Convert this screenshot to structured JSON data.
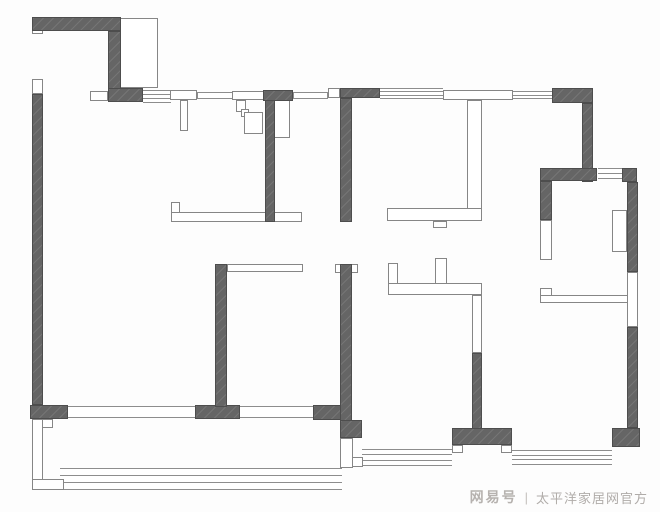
{
  "canvas": {
    "w": 660,
    "h": 512,
    "bg": "#fdfdfd"
  },
  "colors": {
    "wall_fill": "#656565",
    "wall_edge": "#4d4d4d",
    "partition_line": "#868686",
    "window_line": "#8d8d8d",
    "watermark_brand": "#b6b2af",
    "watermark_text": "#b0aca9"
  },
  "watermark": {
    "brand": "网易号",
    "divider": "|",
    "source": "太平洋家居网官方"
  },
  "floorplan": {
    "dark_walls": [
      {
        "name": "wall-entry-top",
        "x": 32,
        "y": 17,
        "w": 89,
        "h": 14
      },
      {
        "name": "wall-entry-right",
        "x": 108,
        "y": 31,
        "w": 13,
        "h": 58
      },
      {
        "name": "wall-entry-corner",
        "x": 108,
        "y": 88,
        "w": 35,
        "h": 14
      },
      {
        "name": "wall-west-exterior",
        "x": 32,
        "y": 94,
        "w": 11,
        "h": 311
      },
      {
        "name": "wall-sw-corner-block",
        "x": 30,
        "y": 405,
        "w": 38,
        "h": 14
      },
      {
        "name": "wall-south-a",
        "x": 195,
        "y": 405,
        "w": 45,
        "h": 14
      },
      {
        "name": "wall-south-b",
        "x": 313,
        "y": 405,
        "w": 39,
        "h": 15
      },
      {
        "name": "wall-bedroom1-left",
        "x": 215,
        "y": 264,
        "w": 12,
        "h": 143
      },
      {
        "name": "wall-bedroom1-right",
        "x": 340,
        "y": 264,
        "w": 12,
        "h": 158
      },
      {
        "name": "wall-bay-corner",
        "x": 340,
        "y": 420,
        "w": 22,
        "h": 18
      },
      {
        "name": "wall-kitchen",
        "x": 265,
        "y": 98,
        "w": 10,
        "h": 124
      },
      {
        "name": "wall-kitchen-header",
        "x": 263,
        "y": 90,
        "w": 30,
        "h": 11
      },
      {
        "name": "wall-mid-upper",
        "x": 340,
        "y": 98,
        "w": 12,
        "h": 124
      },
      {
        "name": "wall-mid-header",
        "x": 340,
        "y": 88,
        "w": 40,
        "h": 10
      },
      {
        "name": "wall-ne-corner",
        "x": 552,
        "y": 88,
        "w": 41,
        "h": 15
      },
      {
        "name": "wall-ne-connector",
        "x": 582,
        "y": 103,
        "w": 11,
        "h": 79
      },
      {
        "name": "wall-rightroom-top",
        "x": 540,
        "y": 168,
        "w": 57,
        "h": 13
      },
      {
        "name": "wall-rightroom-ne",
        "x": 622,
        "y": 168,
        "w": 15,
        "h": 14
      },
      {
        "name": "wall-east-upper",
        "x": 627,
        "y": 182,
        "w": 11,
        "h": 90
      },
      {
        "name": "wall-east-lower",
        "x": 627,
        "y": 327,
        "w": 11,
        "h": 101
      },
      {
        "name": "wall-se-corner-block",
        "x": 612,
        "y": 428,
        "w": 28,
        "h": 19
      },
      {
        "name": "wall-rightroom-left",
        "x": 540,
        "y": 181,
        "w": 12,
        "h": 39
      },
      {
        "name": "wall-bath-south",
        "x": 472,
        "y": 353,
        "w": 10,
        "h": 77
      },
      {
        "name": "wall-south-t-block",
        "x": 452,
        "y": 428,
        "w": 60,
        "h": 17
      }
    ],
    "outline_boxes": [
      {
        "name": "frame-entry-wall-tab",
        "x": 32,
        "y": 26,
        "w": 11,
        "h": 8
      },
      {
        "name": "frame-west-door",
        "x": 32,
        "y": 79,
        "w": 11,
        "h": 15
      },
      {
        "name": "frame-entry-door",
        "x": 90,
        "y": 91,
        "w": 18,
        "h": 10
      },
      {
        "name": "closet-entry",
        "x": 118,
        "y": 18,
        "w": 40,
        "h": 70
      },
      {
        "name": "partition-entry-cap",
        "x": 170,
        "y": 90,
        "w": 27,
        "h": 10
      },
      {
        "name": "partition-entry-leg",
        "x": 180,
        "y": 100,
        "w": 8,
        "h": 31
      },
      {
        "name": "frame-kitchen-door",
        "x": 232,
        "y": 91,
        "w": 36,
        "h": 9
      },
      {
        "name": "duct-step-1",
        "x": 236,
        "y": 100,
        "w": 10,
        "h": 12
      },
      {
        "name": "duct-step-2",
        "x": 241,
        "y": 109,
        "w": 8,
        "h": 8
      },
      {
        "name": "duct-step-3",
        "x": 244,
        "y": 112,
        "w": 19,
        "h": 22
      },
      {
        "name": "cabinet-kitchen",
        "x": 274,
        "y": 100,
        "w": 16,
        "h": 38
      },
      {
        "name": "frame-mid-door",
        "x": 328,
        "y": 88,
        "w": 12,
        "h": 10
      },
      {
        "name": "cap-bedroom1-right-a",
        "x": 335,
        "y": 264,
        "w": 7,
        "h": 9
      },
      {
        "name": "cap-bedroom1-right-b",
        "x": 351,
        "y": 264,
        "w": 7,
        "h": 9
      },
      {
        "name": "lintel-bedroom1",
        "x": 227,
        "y": 264,
        "w": 76,
        "h": 8
      },
      {
        "name": "shelf-living-tab",
        "x": 171,
        "y": 202,
        "w": 9,
        "h": 20
      },
      {
        "name": "shelf-living-bar",
        "x": 171,
        "y": 212,
        "w": 131,
        "h": 10
      },
      {
        "name": "frame-midroom-door-head",
        "x": 443,
        "y": 90,
        "w": 70,
        "h": 10
      },
      {
        "name": "partition-midroom",
        "x": 467,
        "y": 100,
        "w": 15,
        "h": 121
      },
      {
        "name": "bar-midroom-bottom",
        "x": 387,
        "y": 208,
        "w": 95,
        "h": 13
      },
      {
        "name": "notch-midroom",
        "x": 433,
        "y": 221,
        "w": 14,
        "h": 7
      },
      {
        "name": "bath-hook",
        "x": 388,
        "y": 263,
        "w": 10,
        "h": 21
      },
      {
        "name": "bath-wall-horizontal",
        "x": 388,
        "y": 283,
        "w": 94,
        "h": 12
      },
      {
        "name": "bath-tab",
        "x": 435,
        "y": 258,
        "w": 12,
        "h": 26
      },
      {
        "name": "bath-wall-vertical",
        "x": 472,
        "y": 295,
        "w": 10,
        "h": 58
      },
      {
        "name": "balcony-left-wall",
        "x": 32,
        "y": 419,
        "w": 11,
        "h": 71
      },
      {
        "name": "balcony-notch",
        "x": 42,
        "y": 419,
        "w": 11,
        "h": 9
      },
      {
        "name": "balcony-sw-corner",
        "x": 32,
        "y": 479,
        "w": 32,
        "h": 11
      },
      {
        "name": "balcony-right-channel",
        "x": 340,
        "y": 438,
        "w": 13,
        "h": 30
      },
      {
        "name": "balcony-channel-tab",
        "x": 352,
        "y": 457,
        "w": 11,
        "h": 10
      },
      {
        "name": "window-box-rightroom-left",
        "x": 540,
        "y": 220,
        "w": 12,
        "h": 40
      },
      {
        "name": "window-box-east",
        "x": 627,
        "y": 272,
        "w": 11,
        "h": 55
      },
      {
        "name": "wardrobe-rightroom",
        "x": 612,
        "y": 210,
        "w": 15,
        "h": 42
      },
      {
        "name": "shelf-rightroom-tab",
        "x": 540,
        "y": 288,
        "w": 12,
        "h": 15
      },
      {
        "name": "shelf-rightroom-bar",
        "x": 540,
        "y": 295,
        "w": 88,
        "h": 8
      },
      {
        "name": "tab-t-block-left",
        "x": 452,
        "y": 445,
        "w": 11,
        "h": 8
      },
      {
        "name": "tab-t-block-right",
        "x": 501,
        "y": 445,
        "w": 11,
        "h": 8
      }
    ],
    "open_frames": [
      {
        "name": "opening-balcony-door",
        "x": 68,
        "y": 406,
        "w": 127,
        "h": 12
      },
      {
        "name": "opening-south",
        "x": 240,
        "y": 406,
        "w": 73,
        "h": 12
      }
    ],
    "thin_walls": [
      {
        "name": "thinwall-top-a",
        "x": 197,
        "y": 92,
        "w": 36,
        "h": 7
      },
      {
        "name": "thinwall-top-b",
        "x": 293,
        "y": 92,
        "w": 35,
        "h": 7
      }
    ],
    "window_bands": [
      {
        "name": "window-entry",
        "x": 143,
        "y": 90,
        "w": 28,
        "h": 13,
        "lines": 4
      },
      {
        "name": "window-midroom-top",
        "x": 380,
        "y": 88,
        "w": 63,
        "h": 11,
        "lines": 4
      },
      {
        "name": "window-top-right",
        "x": 513,
        "y": 91,
        "w": 39,
        "h": 8,
        "lines": 3
      },
      {
        "name": "window-rightroom-top",
        "x": 598,
        "y": 168,
        "w": 24,
        "h": 11,
        "lines": 3
      },
      {
        "name": "window-balcony",
        "x": 60,
        "y": 468,
        "w": 282,
        "h": 22,
        "lines": 4
      },
      {
        "name": "window-bedroom2-bay",
        "x": 362,
        "y": 449,
        "w": 90,
        "h": 17,
        "lines": 4
      },
      {
        "name": "window-rightroom-bay",
        "x": 512,
        "y": 450,
        "w": 100,
        "h": 15,
        "lines": 4
      }
    ]
  }
}
